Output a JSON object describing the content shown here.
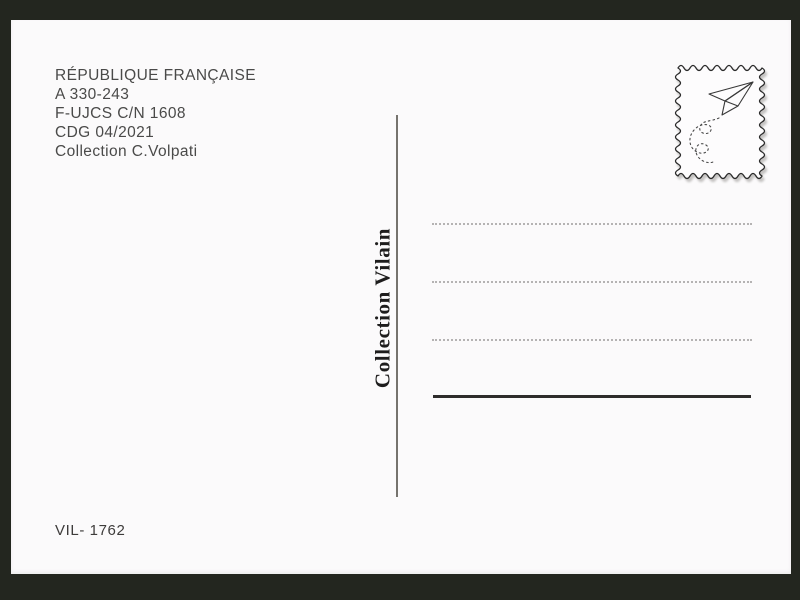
{
  "colors": {
    "background": "#23261f",
    "card": "#fbfafb",
    "caption_ink": "#4a4a49",
    "publisher_ink": "#1e1d1d",
    "address_line_gray": "#b5b3b3",
    "divider_gray": "#76736e",
    "signature_line_ink": "#2e2c2b",
    "stamp_outline": "#2c2c2c"
  },
  "info_block": {
    "lines": [
      "RÉPUBLIQUE FRANÇAISE",
      "A 330-243",
      "F-UJCS C/N 1608",
      "CDG 04/2021",
      "Collection C.Volpati"
    ]
  },
  "stamp": {
    "icon": "paper-plane-icon",
    "frame": "wavy-stamp-border"
  },
  "publisher_label": "Collection Vilain",
  "address_area": {
    "dotted_lines_count": 3,
    "signature_lines_count": 1
  },
  "reference_number": "VIL- 1762"
}
